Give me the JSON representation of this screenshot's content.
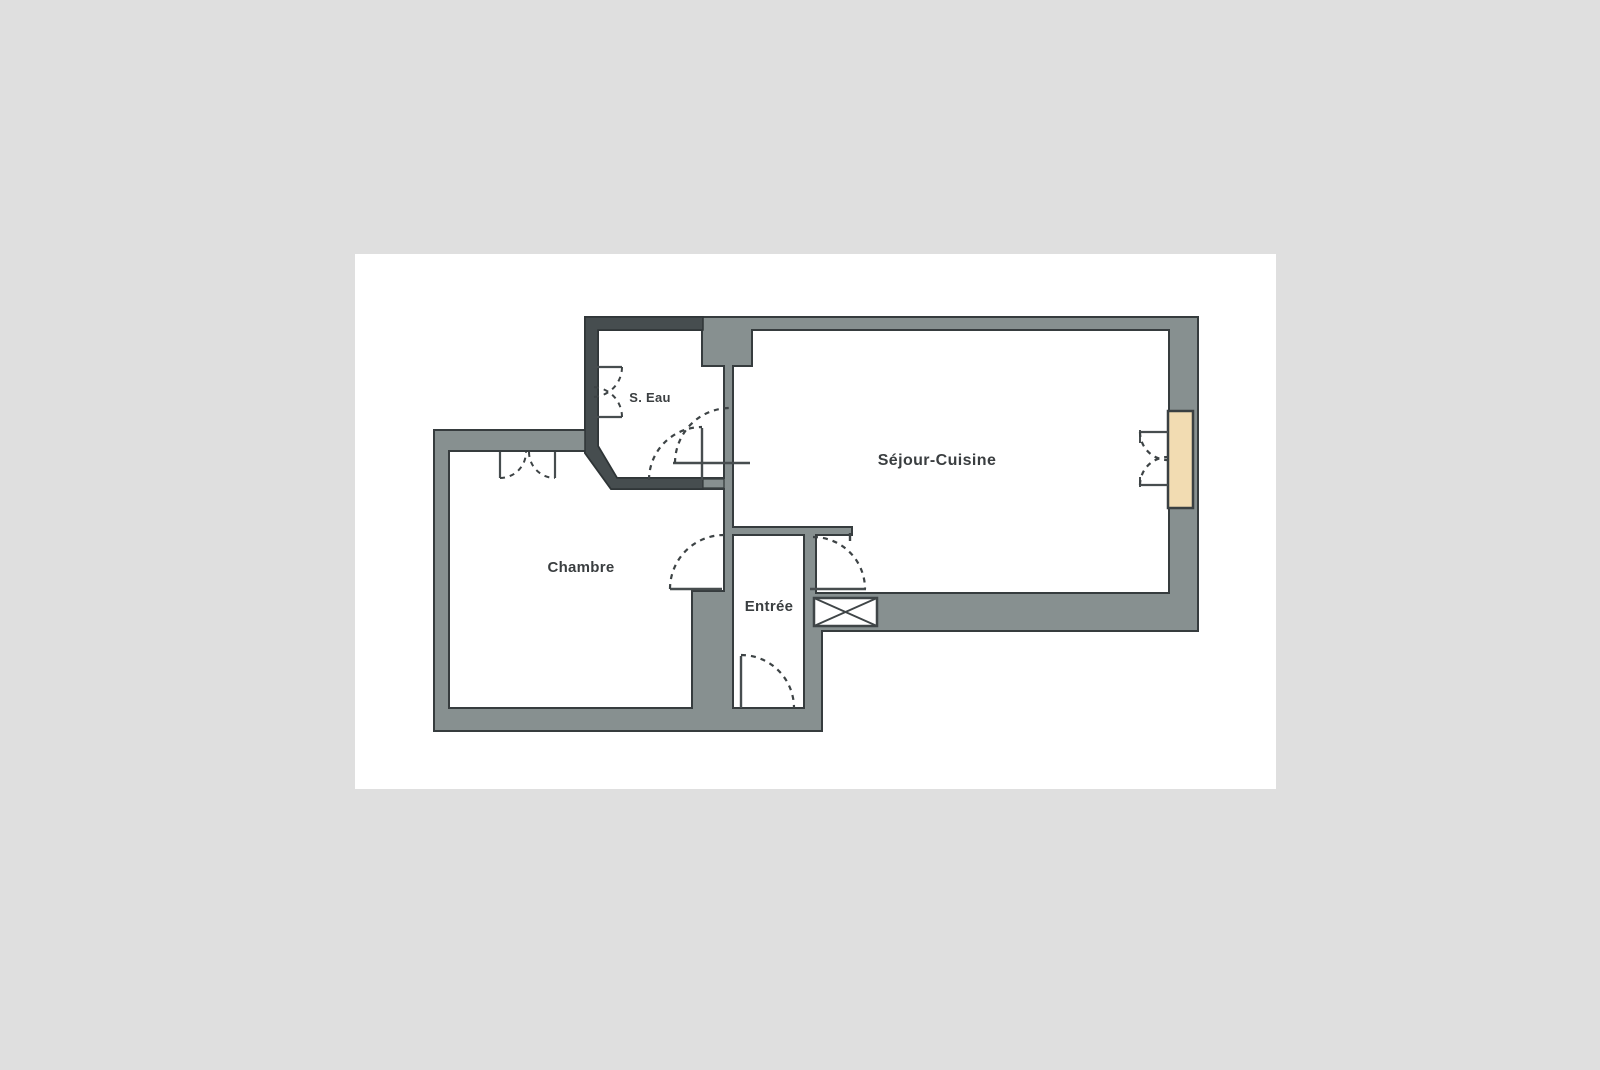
{
  "scene": {
    "background_color": "#dfdfdf",
    "page_color": "#ffffff",
    "description": "Scanned apartment floor plan on a white page"
  },
  "floorplan": {
    "rooms": [
      {
        "id": "s_eau",
        "label": "S. Eau"
      },
      {
        "id": "sejour_cuisine",
        "label": "Séjour-Cuisine"
      },
      {
        "id": "chambre",
        "label": "Chambre"
      },
      {
        "id": "entree",
        "label": "Entrée"
      }
    ],
    "colors": {
      "wall_fill": "#879090",
      "wall_dark_fill": "#464d4f",
      "outline": "#363c3e",
      "line": "#474d4f",
      "dashed_line": "#3d4345",
      "window_fill": "#f2dcb2"
    },
    "symbols": [
      "door-swing-arc",
      "double-door-closet",
      "french-window",
      "crossed-shaft-box"
    ]
  }
}
